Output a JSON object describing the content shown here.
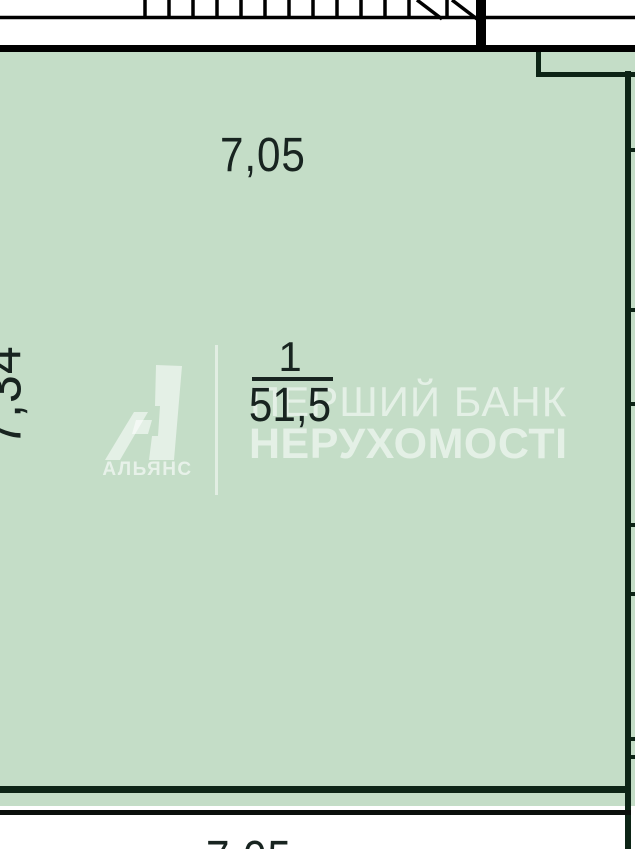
{
  "room": {
    "number": "1",
    "area": "51,5"
  },
  "dimensions": {
    "top": "7,05",
    "left": "7,34",
    "bottom": "7,05"
  },
  "watermark": {
    "brand": "АЛЬЯНС",
    "line1": "ПЕРШИЙ БАНК",
    "line2": "НЕРУХОМОСТІ"
  },
  "colors": {
    "room_fill": "#c4ddc7",
    "wall_dark": "#0d2416",
    "line_black": "#000000",
    "dimension_text": "#182420",
    "watermark_text": "rgba(255,255,255,0.55)"
  }
}
